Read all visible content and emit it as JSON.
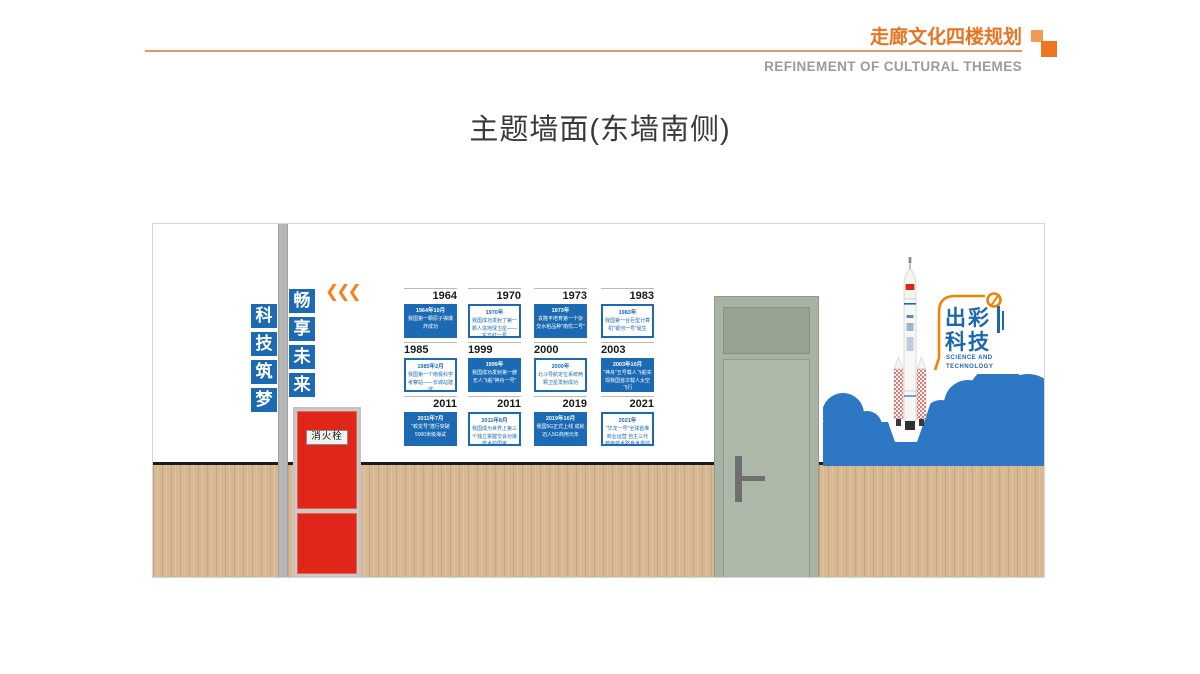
{
  "header": {
    "title": "走廊文化四楼规划",
    "subtitle": "REFINEMENT OF CULTURAL THEMES",
    "accent_color": "#e87320"
  },
  "page_title": "主题墙面(东墙南侧)",
  "wall": {
    "slogan_left": [
      "科",
      "技",
      "筑",
      "梦"
    ],
    "slogan_right": [
      "畅",
      "享",
      "未",
      "来"
    ],
    "chevrons": "❮❮❮",
    "hydrant_label": "消火栓",
    "logo": {
      "line1": "出彩",
      "line2": "科技",
      "subtitle": "SCIENCE AND\nTECHNOLOGY"
    },
    "colors": {
      "panel_blue": "#1b6ab3",
      "cloud_blue": "#2e77c5",
      "hydrant_red": "#e02619",
      "wood": "#d8b893",
      "door_gray_green": "#a9b3a3",
      "accent_orange": "#f58220"
    },
    "timeline": [
      {
        "year": "1964",
        "date": "1964年10月",
        "desc": "我国第一颗原子弹爆炸成功",
        "filled": true,
        "align": "right"
      },
      {
        "year": "1970",
        "date": "1970年",
        "desc": "我国成功发射了第一颗人造地球卫星——东方红一号",
        "filled": false,
        "align": "right"
      },
      {
        "year": "1973",
        "date": "1973年",
        "desc": "袁隆平培育第一个杂交水稻品种\"南优二号\"",
        "filled": true,
        "align": "right"
      },
      {
        "year": "1983",
        "date": "1983年",
        "desc": "我国第一台巨型计算机\"银河一号\"诞生",
        "filled": false,
        "align": "right"
      },
      {
        "year": "1985",
        "date": "1985年2月",
        "desc": "我国第一个南极科学考察站——长城站建成",
        "filled": false,
        "align": "left"
      },
      {
        "year": "1999",
        "date": "1999年",
        "desc": "我国成功发射第一艘无人飞船\"神舟一号\"",
        "filled": true,
        "align": "left"
      },
      {
        "year": "2000",
        "date": "2000年",
        "desc": "北斗导航定位系统两颗卫星发射成功",
        "filled": false,
        "align": "left"
      },
      {
        "year": "2003",
        "date": "2003年10月",
        "desc": "\"神舟\"五号载人飞船实现我国首次载人太空飞行",
        "filled": true,
        "align": "left"
      },
      {
        "year": "2011",
        "date": "2011年7月",
        "desc": "\"蛟龙号\"潜行突破5000米级海试",
        "filled": true,
        "align": "right"
      },
      {
        "year": "2011",
        "date": "2011年8月",
        "desc": "我国成为世界上第三个独立掌握交会对接技术的国家",
        "filled": false,
        "align": "right"
      },
      {
        "year": "2019",
        "date": "2019年10月",
        "desc": "我国5G正式上线 成就迈入5G商用元年",
        "filled": true,
        "align": "right"
      },
      {
        "year": "2021",
        "date": "2021年",
        "desc": "\"华龙一号\"全球首堆商业运营 自主三代核电技术跻身世界前列",
        "filled": false,
        "align": "right"
      }
    ]
  }
}
